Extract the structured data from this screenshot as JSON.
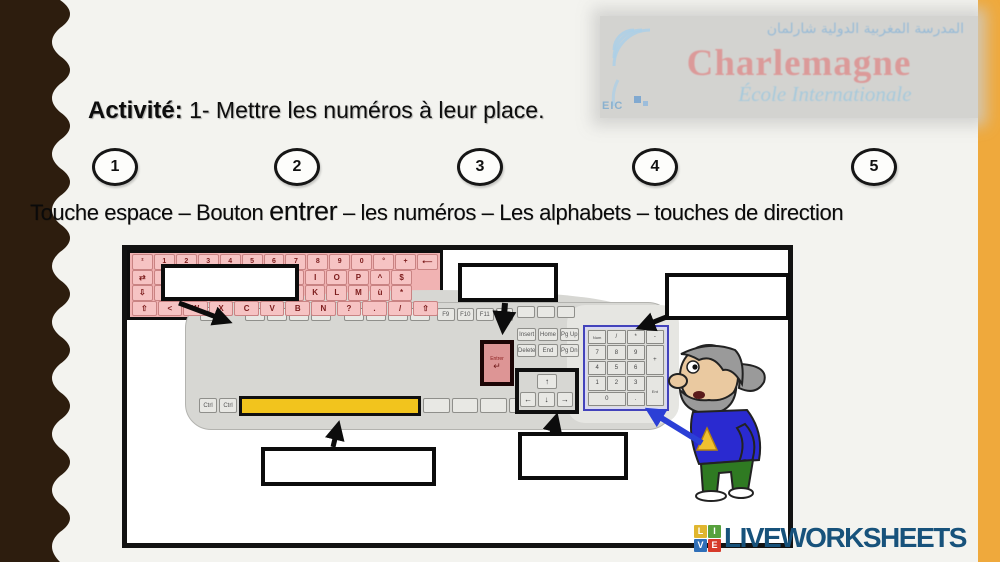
{
  "page": {
    "background": "#f3f3ef",
    "left_band_color": "#2d1d0e",
    "right_band_color": "#efa93c"
  },
  "logo": {
    "arabic": "المدرسة المغربية الدولية شارلمان",
    "name": "Charlemagne",
    "subtitle": "École Internationale",
    "mark": "EIC"
  },
  "activity": {
    "label": "Activité:",
    "instruction": "1- Mettre les numéros à leur  place."
  },
  "numbers": [
    "1",
    "2",
    "3",
    "4",
    "5"
  ],
  "word_bank": {
    "segments": [
      {
        "text": "Touche espace – Bouton "
      },
      {
        "text": "entrer"
      },
      {
        "text": " – les numéros – Les alphabets – touches de direction"
      }
    ]
  },
  "keyboard": {
    "esc": "Esc",
    "fkeys1": [
      "F1",
      "F2",
      "F3",
      "F4"
    ],
    "fkeys2": [
      "F5",
      "F6",
      "F7",
      "F8"
    ],
    "fkeys3": [
      "F9",
      "F10",
      "F11",
      "F12"
    ],
    "sys": [
      "",
      "",
      ""
    ],
    "row_digits": [
      "²",
      "1",
      "2",
      "3",
      "4",
      "5",
      "6",
      "7",
      "8",
      "9",
      "0",
      "°",
      "+",
      "⟵"
    ],
    "row_top": [
      "⇄",
      "A",
      "Z",
      "E",
      "R",
      "T",
      "Y",
      "U",
      "I",
      "O",
      "P",
      "^",
      "$"
    ],
    "row_mid": [
      "⇩",
      "Q",
      "S",
      "D",
      "F",
      "G",
      "H",
      "J",
      "K",
      "L",
      "M",
      "ù",
      "*"
    ],
    "row_low": [
      "⇧",
      "<",
      "W",
      "X",
      "C",
      "V",
      "B",
      "N",
      "?",
      ".",
      "/",
      "⇧"
    ],
    "bottom_left": [
      "Ctrl",
      "Ctrl"
    ],
    "bottom_right": [
      "",
      "",
      "",
      "Ctrl"
    ],
    "nav1": [
      "Insert",
      "Home",
      "Pg Up"
    ],
    "nav2": [
      "Delete",
      "End",
      "Pg Dn"
    ],
    "enter_label": "Entrer",
    "enter_glyph": "↵",
    "arrow_up": "↑",
    "arrows_bottom": [
      "←",
      "↓",
      "→"
    ],
    "keypad": [
      "Num",
      "/",
      "*",
      "-",
      "7",
      "8",
      "9",
      "+",
      "4",
      "5",
      "6",
      "1",
      "2",
      "3",
      "Ent",
      "0",
      "."
    ],
    "highlight_colors": {
      "alphabet_zone": "#f1b3b3",
      "space_bar": "#f2c41d",
      "enter_outline": "#1c0505",
      "keypad_outline": "#4343bb"
    }
  },
  "branding": {
    "wordmark": "LIVEWORKSHEETS",
    "color": "#17527b",
    "tiles": [
      {
        "letter": "L",
        "color": "#e0b62f"
      },
      {
        "letter": "I",
        "color": "#57a13d"
      },
      {
        "letter": "V",
        "color": "#2f6fb8"
      },
      {
        "letter": "E",
        "color": "#d63a2a"
      }
    ]
  }
}
